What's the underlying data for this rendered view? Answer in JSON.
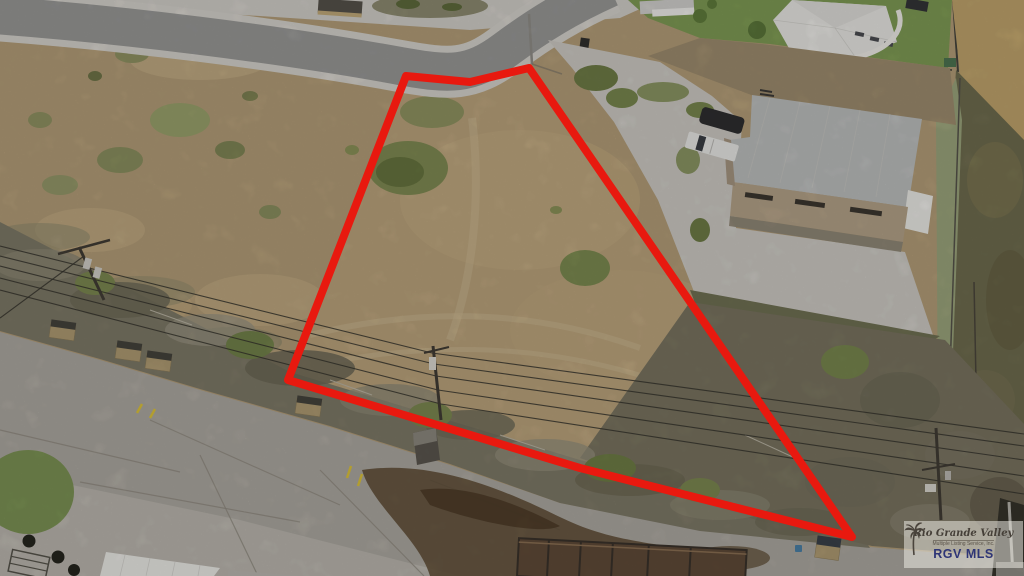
{
  "description": "Aerial drone photo of a vacant dirt corner lot outlined in red, beside a tan commercial building with gray metal roof, curved street at top, brushy easement with power lines and a cracked concrete road at bottom",
  "watermark": {
    "title": "Rio Grande Valley",
    "subtitle": "Multiple Listing Service, Inc.",
    "org": "RGV MLS",
    "icon": "palm-tree-icon"
  },
  "overlay": {
    "boundary_points": "406,76 470,82 529,68 852,537 580,468 288,380"
  },
  "colors": {
    "outline_red": "#e8190f",
    "dirt_field": "#b29c77",
    "asphalt": "#979694",
    "concrete": "#cbc8c2",
    "lawn_green": "#7e9a54",
    "metal_roof": "#babcbb",
    "building_wall": "#b2a087",
    "brush": "#7d7866",
    "watermark_navy": "#2e3576"
  }
}
